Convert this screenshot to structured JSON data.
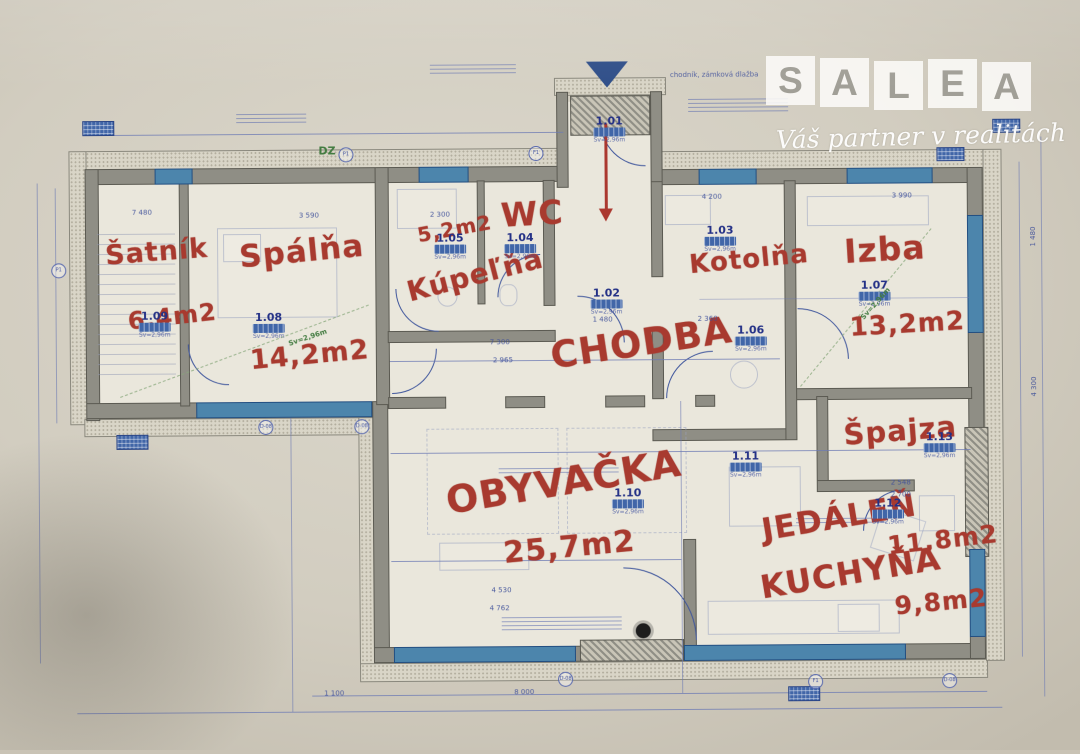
{
  "watermark": {
    "letters": [
      "S",
      "A",
      "L",
      "E",
      "A"
    ],
    "tagline": "Váš partner v realitách"
  },
  "rooms": {
    "entrance": {
      "number": "1.01"
    },
    "chodba": {
      "number": "1.02",
      "name": "CHODBA"
    },
    "kotolna": {
      "number": "1.03",
      "name": "Kotolňa"
    },
    "wc": {
      "number": "1.04",
      "name": "WC"
    },
    "kupelna": {
      "number": "1.05",
      "name": "Kúpeľňa",
      "area": "5,2m2"
    },
    "chodba2": {
      "number": "1.06"
    },
    "izba": {
      "number": "1.07",
      "name": "Izba",
      "area": "13,2m2"
    },
    "spalna": {
      "number": "1.08",
      "name": "Spálňa",
      "area": "14,2m2"
    },
    "satnik": {
      "number": "1.09",
      "name": "Šatník",
      "area": "6,4m2"
    },
    "obyvacka": {
      "number": "1.10",
      "name": "OBYVAČKA",
      "area": "25,7m2"
    },
    "jedalen": {
      "number": "1.11",
      "name": "JEDÁLEŇ",
      "area": "11,8m2"
    },
    "kuchyna": {
      "number": "1.12",
      "name": "KUCHYŇA",
      "area": "9,8m2"
    },
    "spajza": {
      "number": "1.13",
      "name": "Špajza"
    }
  },
  "annotations": {
    "sidewalk": "chodník, zámková dlažba",
    "dz": "DZ",
    "ceiling_height": "Sv=2,96m"
  },
  "dimensions": {
    "top_satnik": "7 480",
    "top_spalna": "3 590",
    "top_kotolna": "4 200",
    "top_izba": "3 990",
    "kupelna_w": "2 300",
    "chodba_a": "1 480",
    "chodba_b": "7 300",
    "chodba_c": "2 965",
    "izba_l": "2 360",
    "liv_a": "4 530",
    "liv_b": "4 762",
    "bottom_a": "1 100",
    "bottom_b": "8 000",
    "spajza_a": "2 548",
    "spajza_b": "2 700",
    "right_a": "1 480",
    "right_b": "4 300"
  },
  "markers": {
    "m1": "D-08",
    "m2": "F1",
    "m3": "P1"
  },
  "colors": {
    "label_red": "#b0382c",
    "line_blue": "#3c55a2",
    "window_blue": "#4886b0",
    "wall_gray": "#8f8e84",
    "paper": "#d2cdc0",
    "green": "#3f7d3d"
  }
}
